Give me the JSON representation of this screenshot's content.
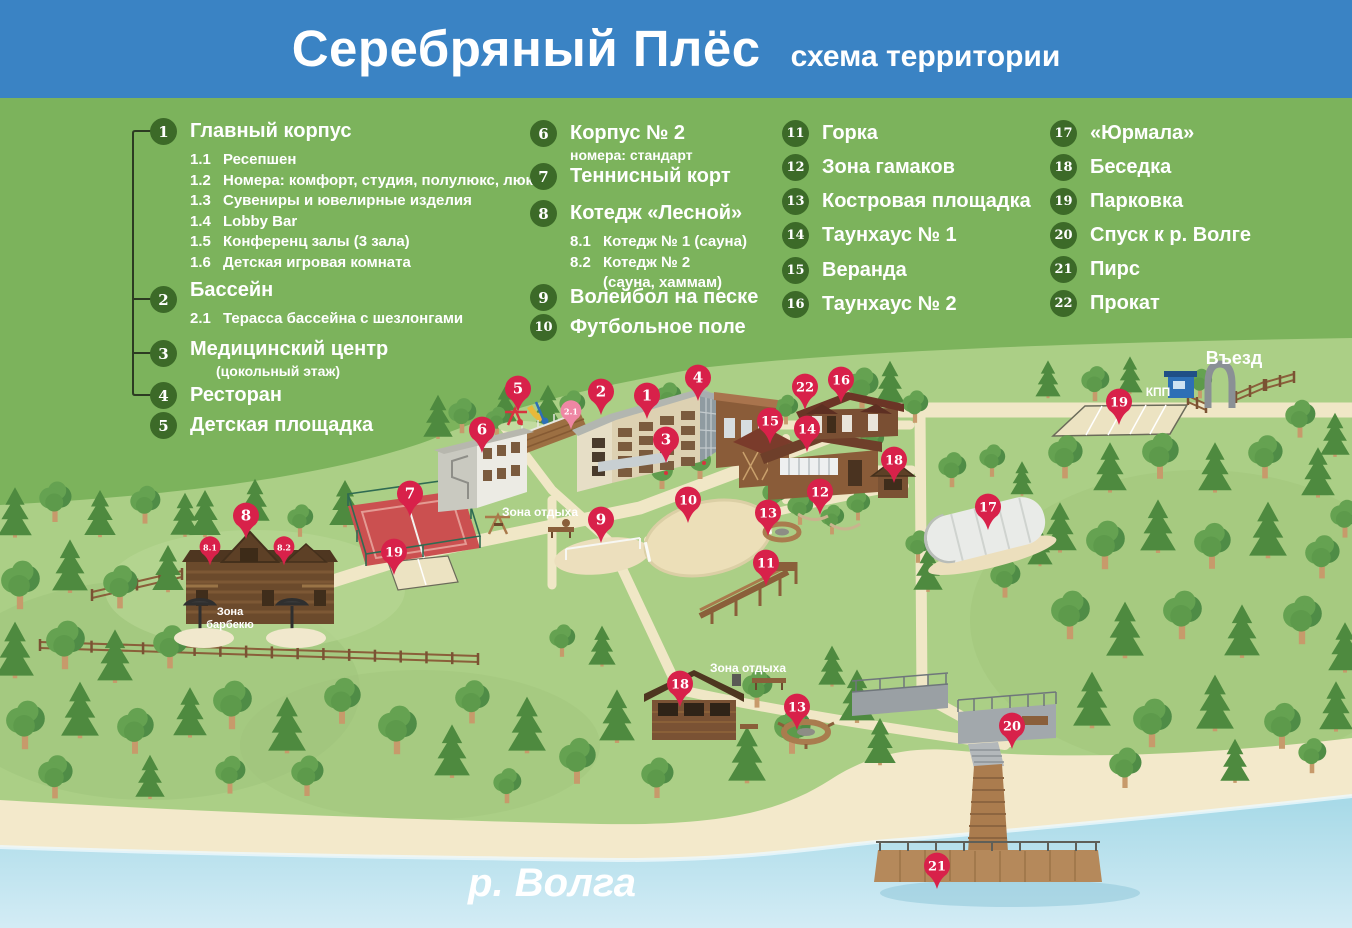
{
  "header": {
    "title": "Серебряный Плёс",
    "subtitle": "схема территории"
  },
  "legend": {
    "columns": [
      {
        "items": [
          {
            "num": "1",
            "label": "Главный корпус",
            "subs": [
              {
                "num": "1.1",
                "label": "Ресепшен"
              },
              {
                "num": "1.2",
                "label": "Номера: комфорт, студия, полулюкс, люкс"
              },
              {
                "num": "1.3",
                "label": "Сувениры и ювелирные изделия"
              },
              {
                "num": "1.4",
                "label": "Lobby Bar"
              },
              {
                "num": "1.5",
                "label": "Конференц залы (3 зала)"
              },
              {
                "num": "1.6",
                "label": "Детская игровая комната"
              }
            ]
          },
          {
            "num": "2",
            "label": "Бассейн",
            "subs": [
              {
                "num": "2.1",
                "label": "Терасса бассейна с шезлонгами"
              }
            ]
          },
          {
            "num": "3",
            "label": "Медицинский центр",
            "note": "(цокольный этаж)"
          },
          {
            "num": "4",
            "label": "Ресторан"
          },
          {
            "num": "5",
            "label": "Детская площадка"
          }
        ]
      },
      {
        "items": [
          {
            "num": "6",
            "label": "Корпус № 2",
            "note": "номера: стандарт"
          },
          {
            "num": "7",
            "label": "Теннисный корт"
          },
          {
            "num": "8",
            "label": "Котедж «Лесной»",
            "subs": [
              {
                "num": "8.1",
                "label": "Котедж № 1 (сауна)"
              },
              {
                "num": "8.2",
                "label": "Котедж № 2",
                "note": "(сауна, хаммам)"
              }
            ]
          },
          {
            "num": "9",
            "label": "Волейбол на песке"
          },
          {
            "num": "10",
            "label": "Футбольное поле"
          }
        ]
      },
      {
        "items": [
          {
            "num": "11",
            "label": "Горка"
          },
          {
            "num": "12",
            "label": "Зона гамаков"
          },
          {
            "num": "13",
            "label": "Костровая площадка"
          },
          {
            "num": "14",
            "label": "Таунхаус № 1"
          },
          {
            "num": "15",
            "label": "Веранда"
          },
          {
            "num": "16",
            "label": "Таунхаус № 2"
          }
        ]
      },
      {
        "items": [
          {
            "num": "17",
            "label": "«Юрмала»"
          },
          {
            "num": "18",
            "label": "Беседка"
          },
          {
            "num": "19",
            "label": "Парковка"
          },
          {
            "num": "20",
            "label": "Спуск к р. Волге"
          },
          {
            "num": "21",
            "label": "Пирс"
          },
          {
            "num": "22",
            "label": "Прокат"
          }
        ]
      }
    ]
  },
  "map": {
    "labels": [
      {
        "id": "entrance",
        "text": "Въезд",
        "x": 1234,
        "y": 364,
        "size": 18
      },
      {
        "id": "checkpoint",
        "text": "КПП",
        "x": 1158,
        "y": 396,
        "size": 12
      },
      {
        "id": "rest-zone-1",
        "text": "Зона отдыха",
        "x": 540,
        "y": 516,
        "size": 12
      },
      {
        "id": "rest-zone-2",
        "text": "Зона отдыха",
        "x": 748,
        "y": 672,
        "size": 12
      },
      {
        "id": "bbq-zone",
        "text": "Зона барбекю",
        "x": 230,
        "y": 615,
        "size": 11,
        "multiline": true
      },
      {
        "id": "river",
        "text": "р. Волга",
        "x": 552,
        "y": 896,
        "size": 40,
        "italic": true
      }
    ],
    "markers": [
      {
        "num": "1",
        "x": 647,
        "y": 396
      },
      {
        "num": "2",
        "x": 601,
        "y": 392
      },
      {
        "num": "2.1",
        "x": 571,
        "y": 411,
        "variant": "pink-small"
      },
      {
        "num": "3",
        "x": 666,
        "y": 440
      },
      {
        "num": "4",
        "x": 698,
        "y": 378
      },
      {
        "num": "5",
        "x": 518,
        "y": 389
      },
      {
        "num": "6",
        "x": 482,
        "y": 430
      },
      {
        "num": "7",
        "x": 410,
        "y": 494
      },
      {
        "num": "8",
        "x": 246,
        "y": 516
      },
      {
        "num": "8.1",
        "x": 210,
        "y": 547,
        "variant": "small"
      },
      {
        "num": "8.2",
        "x": 284,
        "y": 547,
        "variant": "small"
      },
      {
        "num": "9",
        "x": 601,
        "y": 520
      },
      {
        "num": "10",
        "x": 688,
        "y": 500
      },
      {
        "num": "11",
        "x": 766,
        "y": 563
      },
      {
        "num": "12",
        "x": 820,
        "y": 492
      },
      {
        "num": "13",
        "x": 768,
        "y": 513
      },
      {
        "num": "13",
        "x": 797,
        "y": 707
      },
      {
        "num": "14",
        "x": 807,
        "y": 429
      },
      {
        "num": "15",
        "x": 770,
        "y": 421
      },
      {
        "num": "16",
        "x": 841,
        "y": 380
      },
      {
        "num": "17",
        "x": 988,
        "y": 507
      },
      {
        "num": "18",
        "x": 894,
        "y": 460
      },
      {
        "num": "18",
        "x": 680,
        "y": 684
      },
      {
        "num": "19",
        "x": 1119,
        "y": 402
      },
      {
        "num": "19",
        "x": 394,
        "y": 552
      },
      {
        "num": "20",
        "x": 1012,
        "y": 726
      },
      {
        "num": "21",
        "x": 937,
        "y": 866
      },
      {
        "num": "22",
        "x": 805,
        "y": 387
      }
    ]
  },
  "colors": {
    "header_bg": "#3a83c4",
    "legend_bg": "#7cb35c",
    "legend_circle": "#3c6a28",
    "map_ground": "#abcf86",
    "path_beige": "#f0e7c6",
    "sand": "#f3e9cb",
    "water_top": "#a6d9e7",
    "water_bottom": "#d3ecf5",
    "marker_red": "#d8214a",
    "marker_pink": "#ee87a4"
  }
}
